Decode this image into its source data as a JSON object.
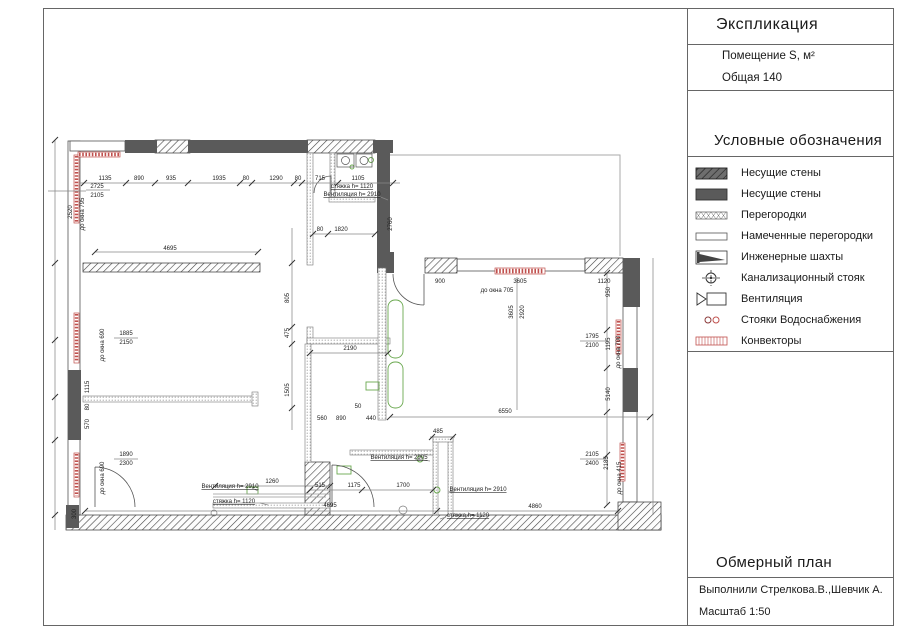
{
  "panel": {
    "explication_title": "Экспликация",
    "room_header": "Помещение S, м²",
    "total_row": "Общая 140",
    "legend_title": "Условные обозначения",
    "legend_items": [
      {
        "symbol": "hatch-dark",
        "label": "Несущие стены"
      },
      {
        "symbol": "solid-dark",
        "label": "Несущие стены"
      },
      {
        "symbol": "crosshatch",
        "label": "Перегородки"
      },
      {
        "symbol": "outline",
        "label": "Намеченные перегородки"
      },
      {
        "symbol": "shaft",
        "label": "Инженерные шахты"
      },
      {
        "symbol": "sewer-riser",
        "label": "Канализационный стояк"
      },
      {
        "symbol": "vent",
        "label": "Вентиляция"
      },
      {
        "symbol": "water-risers",
        "label": "Стояки Водоснабжения"
      },
      {
        "symbol": "convector",
        "label": "Конвекторы"
      }
    ],
    "plan_title": "Обмерный план",
    "authors": "Выполнили Стрелкова.В.,Шевчик А.",
    "scale": "Масштаб 1:50"
  },
  "colors": {
    "wall_dark": "#5a5a5a",
    "convector_red": "#c0504d",
    "riser_green": "#6aa84f",
    "line_gray": "#666666"
  },
  "plan_annotations": [
    [
      105,
      180,
      "1135",
      ""
    ],
    [
      139,
      180,
      "890",
      ""
    ],
    [
      171,
      180,
      "935",
      ""
    ],
    [
      219,
      180,
      "1935",
      ""
    ],
    [
      246,
      180,
      "80",
      ""
    ],
    [
      276,
      180,
      "1290",
      ""
    ],
    [
      298,
      180,
      "80",
      ""
    ],
    [
      320,
      180,
      "715",
      ""
    ],
    [
      358,
      180,
      "1105",
      ""
    ],
    [
      97,
      188,
      "2725",
      ""
    ],
    [
      97,
      197,
      "2105",
      ""
    ],
    [
      84,
      214,
      "до окна 795",
      "r"
    ],
    [
      72,
      212,
      "2520",
      "r"
    ],
    [
      170,
      250,
      "4695",
      ""
    ],
    [
      104,
      345,
      "до окна 690",
      "r"
    ],
    [
      126,
      335,
      "1885",
      ""
    ],
    [
      126,
      344,
      "2150",
      ""
    ],
    [
      104,
      478,
      "до окна 690",
      "r"
    ],
    [
      126,
      456,
      "1890",
      ""
    ],
    [
      126,
      465,
      "2300",
      ""
    ],
    [
      89,
      387,
      "1115",
      "r"
    ],
    [
      89,
      407,
      "80",
      "r"
    ],
    [
      89,
      424,
      "570",
      "r"
    ],
    [
      76,
      514,
      "300",
      "r"
    ],
    [
      320,
      231,
      "80",
      ""
    ],
    [
      341,
      231,
      "1820",
      ""
    ],
    [
      392,
      224,
      "2760",
      "r"
    ],
    [
      350,
      350,
      "2190",
      ""
    ],
    [
      289,
      298,
      "805",
      "r"
    ],
    [
      289,
      333,
      "475",
      "r"
    ],
    [
      289,
      390,
      "1505",
      "r"
    ],
    [
      358,
      408,
      "50",
      ""
    ],
    [
      322,
      420,
      "560",
      ""
    ],
    [
      341,
      420,
      "890",
      ""
    ],
    [
      371,
      420,
      "440",
      ""
    ],
    [
      352,
      188,
      "стяжка h= 1120",
      "u"
    ],
    [
      352,
      196,
      "Вентиляция h= 2910",
      "u"
    ],
    [
      440,
      283,
      "900",
      ""
    ],
    [
      520,
      283,
      "3605",
      ""
    ],
    [
      604,
      283,
      "1120",
      ""
    ],
    [
      497,
      292,
      "до окна 705",
      ""
    ],
    [
      513,
      312,
      "3605",
      "r"
    ],
    [
      524,
      312,
      "2920",
      "r"
    ],
    [
      610,
      292,
      "950",
      "r"
    ],
    [
      592,
      338,
      "1795",
      ""
    ],
    [
      592,
      347,
      "2100",
      ""
    ],
    [
      610,
      344,
      "1195",
      "r"
    ],
    [
      620,
      352,
      "до окна 700",
      "r"
    ],
    [
      610,
      394,
      "5140",
      "r"
    ],
    [
      505,
      413,
      "6550",
      ""
    ],
    [
      592,
      456,
      "2105",
      ""
    ],
    [
      592,
      465,
      "2400",
      ""
    ],
    [
      608,
      463,
      "2185",
      "r"
    ],
    [
      621,
      478,
      "до окна 415",
      "r"
    ],
    [
      330,
      507,
      "4695",
      ""
    ],
    [
      535,
      508,
      "4860",
      ""
    ],
    [
      272,
      483,
      "1260",
      ""
    ],
    [
      320,
      487,
      "515",
      ""
    ],
    [
      354,
      487,
      "1175",
      ""
    ],
    [
      403,
      487,
      "1700",
      ""
    ],
    [
      438,
      433,
      "485",
      ""
    ],
    [
      399,
      459,
      "Вентиляция h= 2905",
      "u"
    ],
    [
      478,
      491,
      "Вентиляция h= 2910",
      "u"
    ],
    [
      230,
      488,
      "Вентиляция h= 2910",
      "u"
    ],
    [
      234,
      503,
      "стяжка h= 1120",
      "u"
    ],
    [
      468,
      517,
      "стяжка h= 1120",
      "u"
    ]
  ]
}
